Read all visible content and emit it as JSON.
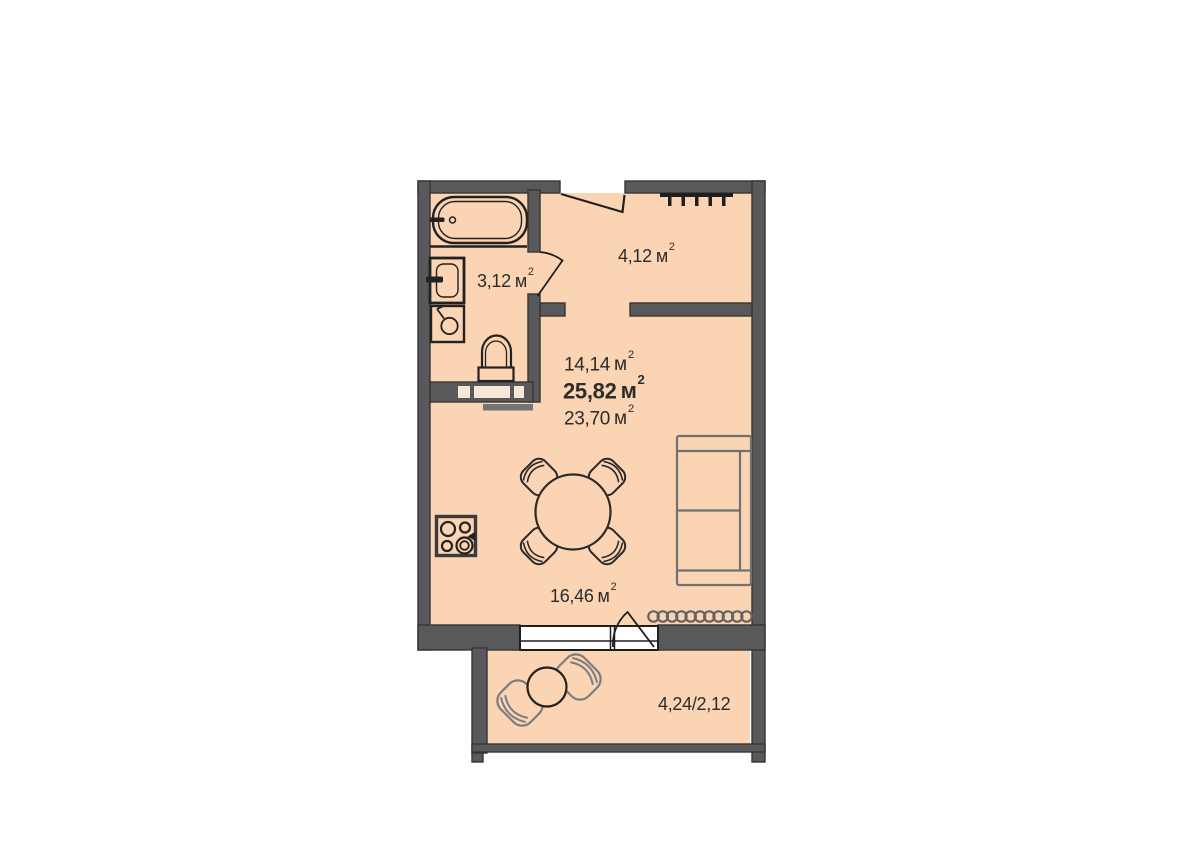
{
  "plan": {
    "rooms": [
      {
        "id": "bathroom",
        "area_value": "3,12",
        "area_unit": "м",
        "area_sup": "2"
      },
      {
        "id": "hallway",
        "area_value": "4,12",
        "area_unit": "м",
        "area_sup": "2"
      },
      {
        "id": "living-room",
        "area_value": "16,46",
        "area_unit": "м",
        "area_sup": "2"
      },
      {
        "id": "balcony",
        "area_value": "4,24/2,12",
        "area_unit": "",
        "area_sup": ""
      }
    ],
    "summary": [
      {
        "name": "living-area",
        "value": "14,14",
        "unit": "м",
        "sup": "2"
      },
      {
        "name": "total-area",
        "value": "25,82",
        "unit": "м",
        "sup": "2"
      },
      {
        "name": "area-without-coef",
        "value": "23,70",
        "unit": "м",
        "sup": "2"
      }
    ],
    "colors": {
      "background": "#FFFFFF",
      "floor": "#FBD4B3",
      "walls": "#59595B",
      "fixture_outline": "#222222",
      "soft_furniture_gray": "#707174",
      "text": "#2C2C2C"
    },
    "furniture": [
      "bathtub",
      "sink",
      "washing-machine",
      "toilet",
      "stove",
      "dining-table",
      "dining-chairs",
      "sofa",
      "radiator",
      "balcony-table",
      "balcony-chairs"
    ],
    "openings": [
      "entrance-door",
      "bathroom-door",
      "balcony-door",
      "window",
      "vent-shaft",
      "threshold-comb"
    ]
  }
}
